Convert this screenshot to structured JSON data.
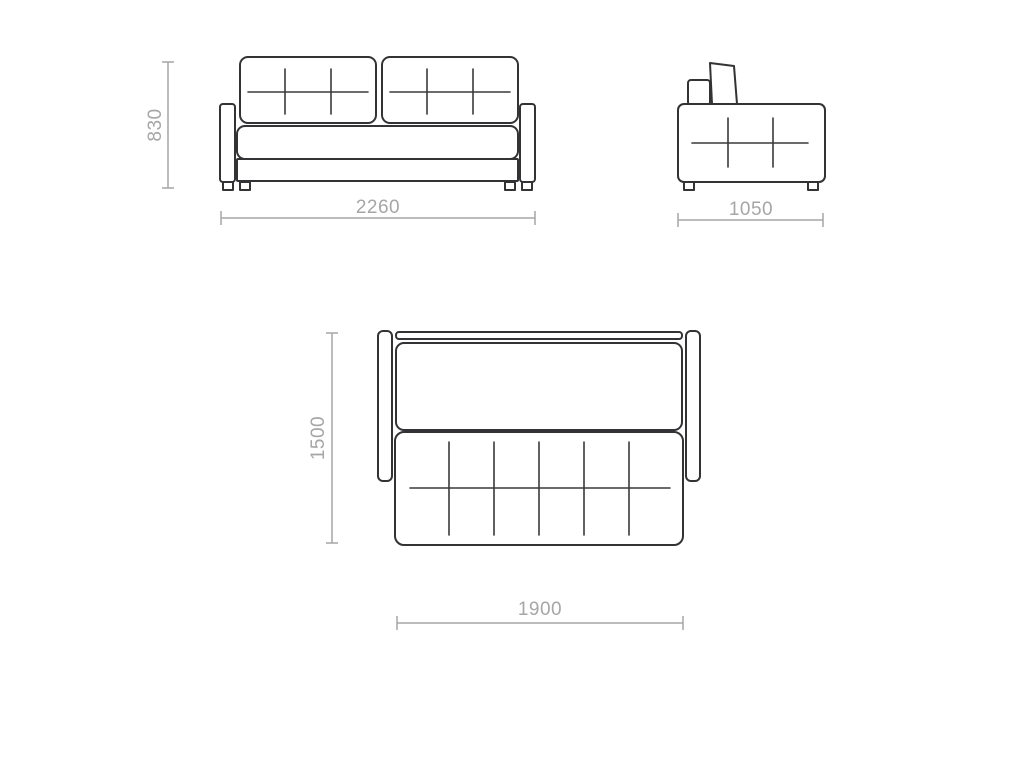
{
  "dimensions": {
    "front_height": "830",
    "front_width": "2260",
    "side_depth": "1050",
    "unfolded_depth": "1500",
    "unfolded_width": "1900"
  },
  "colors": {
    "outline": "#333336",
    "stitch": "#3a3a3c",
    "dimension": "#a6a6a8",
    "background": "#ffffff"
  }
}
